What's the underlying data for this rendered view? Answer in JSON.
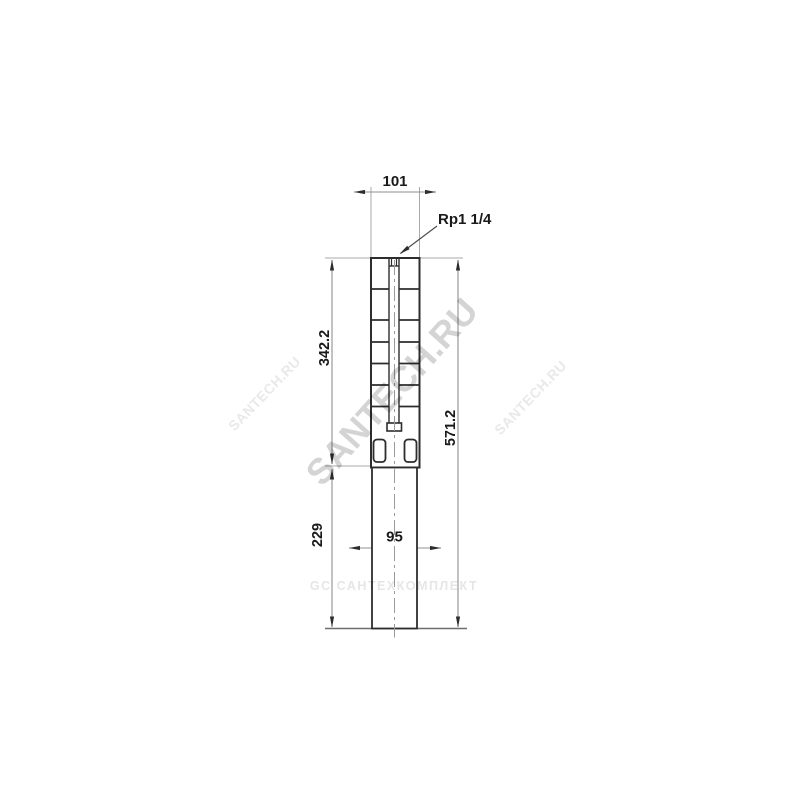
{
  "title": "Submersible borehole pump dimensional drawing",
  "dimensions": {
    "width_top": "101",
    "port_thread": "Rp1 1/4",
    "pump_section_length": "342.2",
    "motor_section_length": "229",
    "total_length": "571.2",
    "width_motor": "95"
  },
  "watermarks": {
    "main": "SANTECH.RU",
    "tile_left": "SANTECH.RU",
    "tile_right": "SANTECH.RU",
    "bottom_line": "GC САНТЕХКОМПЛЕКТ"
  },
  "colors": {
    "outline": "#2d2d2d",
    "dimension_line": "#8f8f8f",
    "extension_line": "#a8a8a8",
    "baseline": "#6e6e6e",
    "leader_line": "#4a4a4a",
    "arrow": "#2d2d2d",
    "text": "#1a1a1a",
    "centerline": "#9a9a9a",
    "watermark_main": "#d4d4d4",
    "watermark_faint": "#e9e9e9",
    "watermark_bottom": "#e6e6e6"
  }
}
